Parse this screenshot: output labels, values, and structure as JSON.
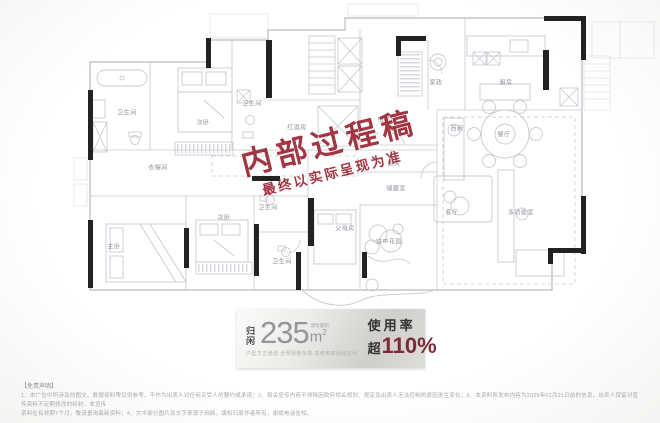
{
  "watermark": {
    "line1": "内部过程稿",
    "line2": "最终以实际呈现为准"
  },
  "floorplan": {
    "rooms": [
      {
        "name": "卫生间",
        "x": 127,
        "y": 112
      },
      {
        "name": "次卧",
        "x": 203,
        "y": 122
      },
      {
        "name": "卫生间",
        "x": 252,
        "y": 103
      },
      {
        "name": "红酒房",
        "x": 297,
        "y": 127
      },
      {
        "name": "电梯厅",
        "x": 387,
        "y": 119
      },
      {
        "name": "玄关",
        "x": 394,
        "y": 163
      },
      {
        "name": "储藏室",
        "x": 396,
        "y": 188
      },
      {
        "name": "家政",
        "x": 436,
        "y": 82
      },
      {
        "name": "厨房",
        "x": 506,
        "y": 82
      },
      {
        "name": "西厨",
        "x": 457,
        "y": 128
      },
      {
        "name": "餐厅",
        "x": 504,
        "y": 134
      },
      {
        "name": "客厅",
        "x": 452,
        "y": 212
      },
      {
        "name": "多功能室",
        "x": 521,
        "y": 212
      },
      {
        "name": "父母房",
        "x": 345,
        "y": 228
      },
      {
        "name": "空中花园",
        "x": 389,
        "y": 241
      },
      {
        "name": "卫生间",
        "x": 268,
        "y": 207
      },
      {
        "name": "卫生间",
        "x": 282,
        "y": 261
      },
      {
        "name": "次卧",
        "x": 224,
        "y": 217
      },
      {
        "name": "主卧",
        "x": 114,
        "y": 246
      },
      {
        "name": "衣帽间",
        "x": 158,
        "y": 167
      }
    ]
  },
  "banner": {
    "name": "归闲",
    "area_value": "235",
    "area_unit": "m",
    "area_sup": "2",
    "area_note": "建筑面积",
    "tagline": "户型方正通透 全明规整布局 高使用率阔绰空间",
    "usage_label": "使用率",
    "usage_prefix": "超",
    "usage_value": "110%"
  },
  "disclaimer": {
    "title": "【免责声明】",
    "line1": "1、本广告中所涉及的图文、数据资料等仅供参考，不作为出卖人对任何买受人的要约或承诺；2、相关宣传内容不排除因政府相关规划、规定及出卖人无法控制的原因发生变化；3、本资料所发布内容为2025年01月21日前的信息，出卖人保留对宣传资料不定期修改的权利，本宣传",
    "line2": "资料在有效期7个月，敬请垂询最新资料；4、文中部分图片及文字来源于网络，版权归原作者所有，谢绝电话告知。"
  },
  "colors": {
    "watermark_red": "#9b2633",
    "usage_red": "#7c2a36",
    "wall_black": "#222222",
    "plan_line": "#b6bac1",
    "label_gray": "#8d929a"
  }
}
